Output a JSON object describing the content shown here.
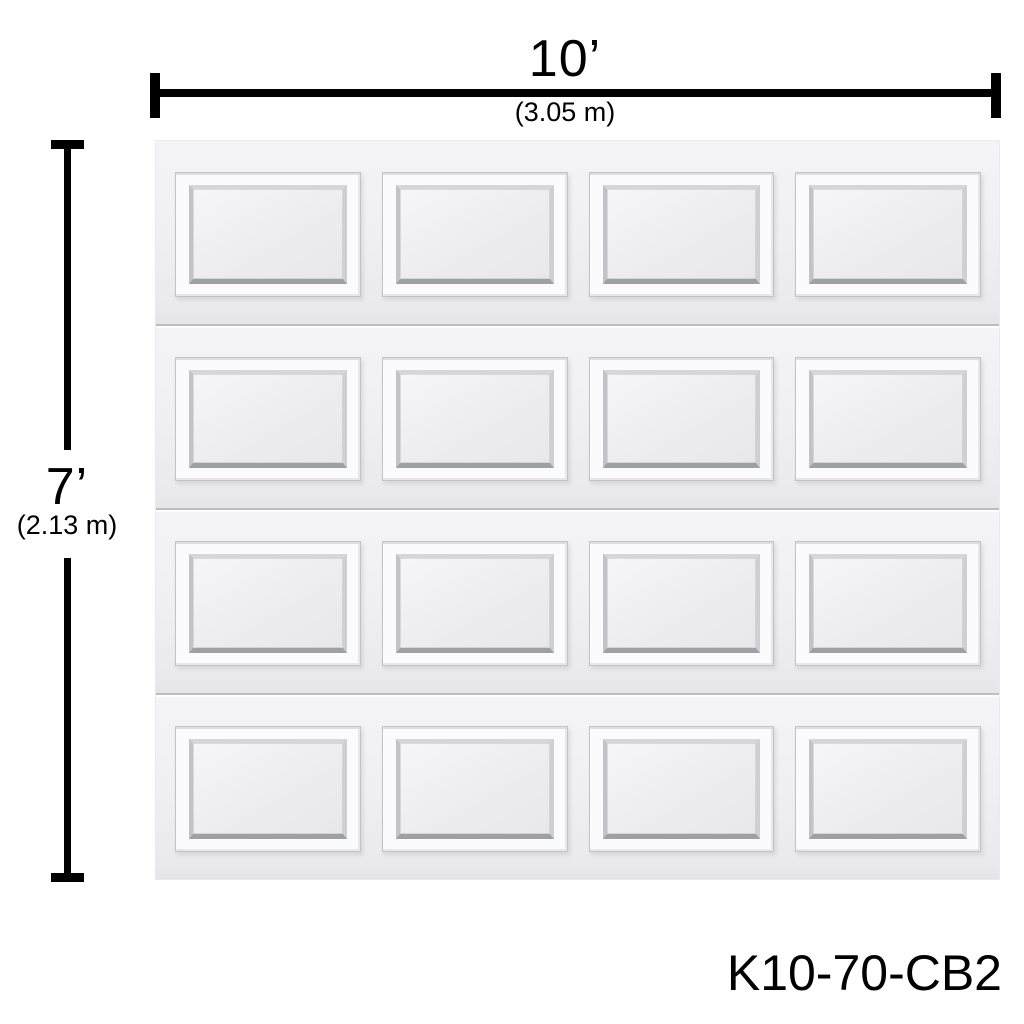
{
  "dimensions": {
    "width_imperial": "10’",
    "width_metric": "(3.05 m)",
    "height_imperial": "7’",
    "height_metric": "(2.13 m)"
  },
  "model_number": "K10-70-CB2",
  "door": {
    "panel_rows": 4,
    "panel_columns": 4,
    "colors": {
      "page_background": "#ffffff",
      "door_background": "#f0f0f2",
      "panel_frame": "#fbfbfd",
      "panel_outline": "#c2c2c7",
      "bevel_shadow": "#9da0a5",
      "section_divider": "#bdbdc1",
      "dimension_line": "#000000",
      "text": "#000000"
    }
  }
}
